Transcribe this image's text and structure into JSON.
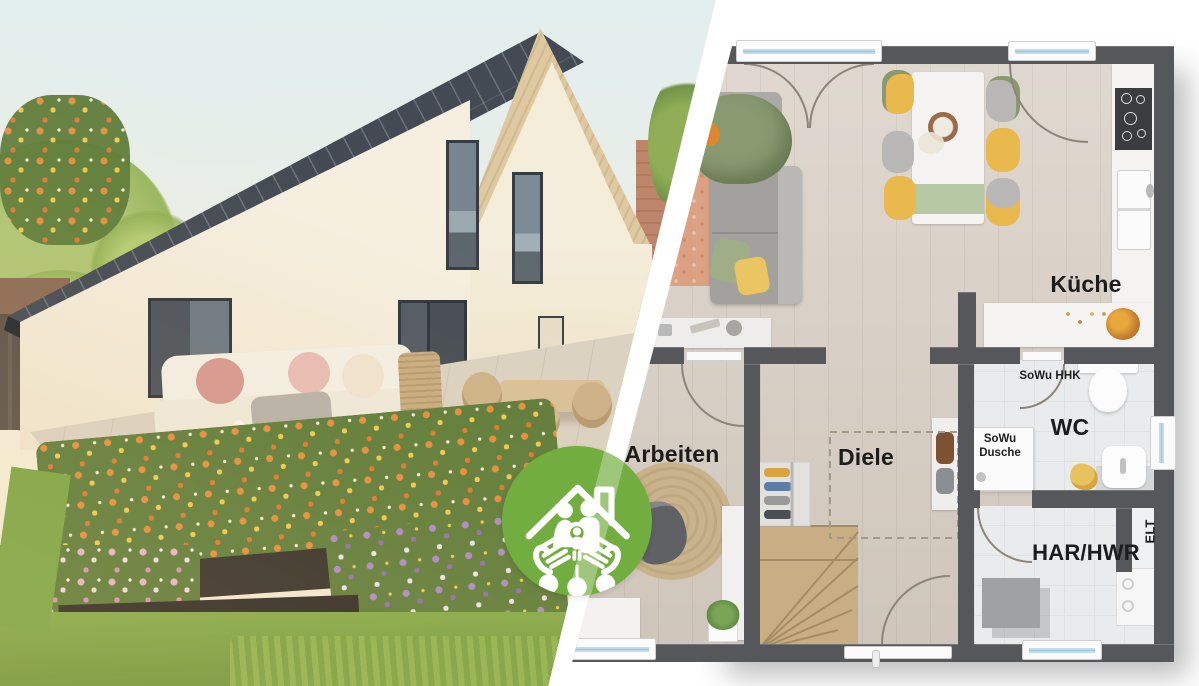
{
  "brand": {
    "logo_icon": "house-family-hands-icon",
    "logo_color": "#72ad3f"
  },
  "floor_plan": {
    "labels": {
      "kueche": "Küche",
      "arbeiten": "Arbeiten",
      "diele": "Diele",
      "wc": "WC",
      "har_hwr": "HAR/HWR",
      "elt": "ELT",
      "sowu_hhk": "SoWu HHK",
      "sowu_dusche_line1": "SoWu",
      "sowu_dusche_line2": "Dusche"
    },
    "palette": {
      "wall": "#55575a",
      "wood_floor": "#d6ccc1",
      "tile_floor": "#e9ebec",
      "window_glass": "#a9cfe2",
      "label_text": "#1c1c1c",
      "stairs_wood": "#c9ae83",
      "accent_yellow_chair": "#e9b94d",
      "accent_green_textile": "#8a9a70",
      "accent_salmon_rug": "#dba183"
    }
  }
}
